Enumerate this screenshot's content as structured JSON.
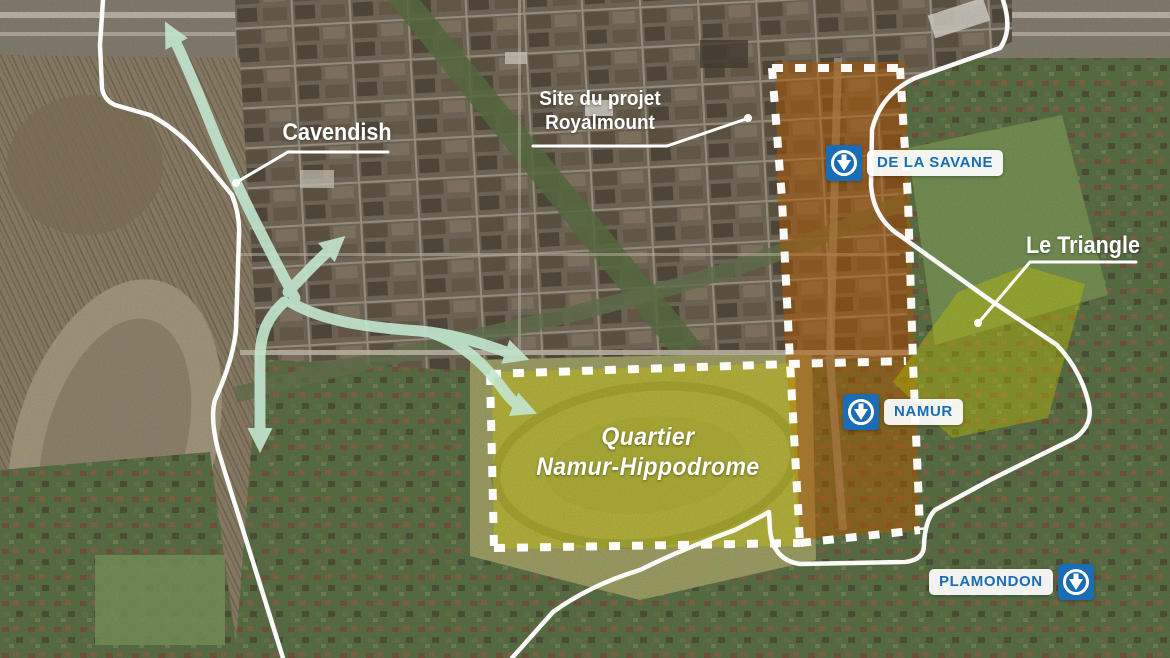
{
  "map": {
    "description": "Aerial map of the Namur-Hippodrome sector (Montreal) with project boundaries, metro stations and access arrows",
    "street_labels": {
      "cavendish": "Cavendish"
    },
    "site_label": {
      "line1": "Site du projet",
      "line2": "Royalmount"
    },
    "area_labels": {
      "le_triangle": "Le Triangle",
      "quartier_line1": "Quartier",
      "quartier_line2": "Namur-Hippodrome"
    },
    "metro": {
      "de_la_savane": "DE LA SAVANE",
      "namur": "NAMUR",
      "plamondon": "PLAMONDON"
    },
    "icons": {
      "metro_logo": "stm-metro-down-arrow-icon"
    },
    "colors": {
      "metro_blue": "#1a6cb5",
      "boundary_white": "#ffffff",
      "highlight_orange": "#c86400",
      "highlight_yellow": "#e3df00",
      "arrow_green": "#c2e6cf"
    }
  }
}
